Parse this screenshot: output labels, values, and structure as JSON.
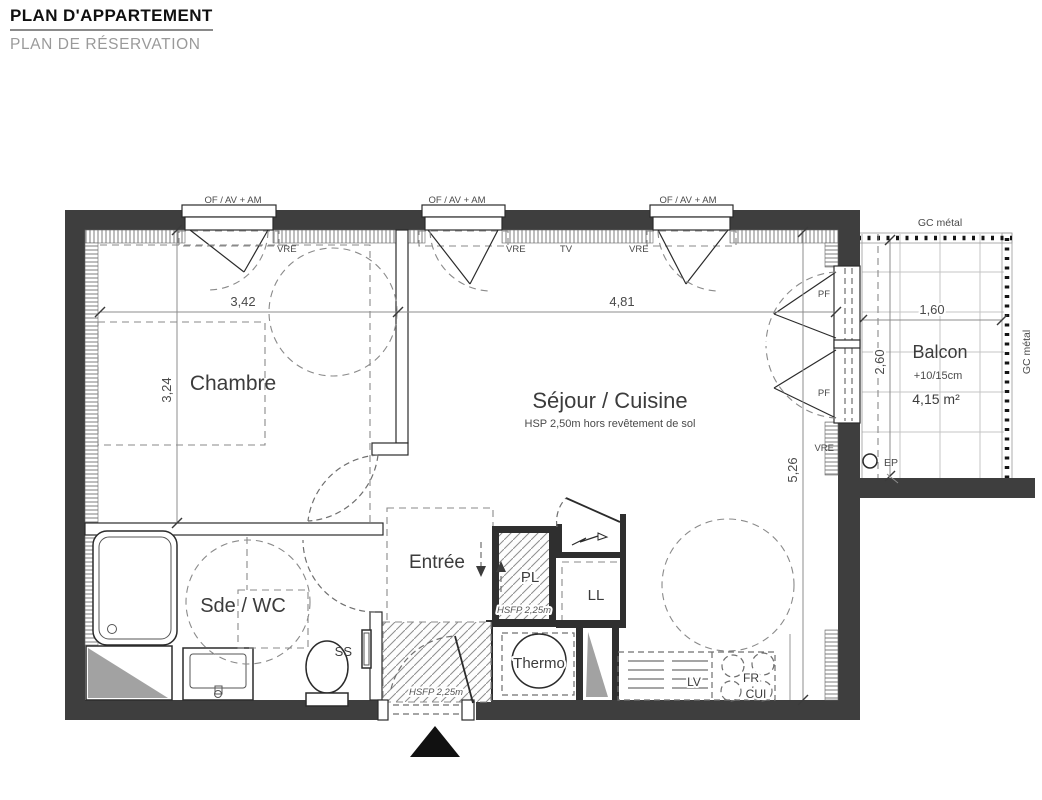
{
  "header": {
    "title": "PLAN D'APPARTEMENT",
    "subtitle": "PLAN DE RÉSERVATION"
  },
  "plan": {
    "window_label": "OF / AV + AM",
    "labels": {
      "vre": "VRE",
      "tv": "TV",
      "pf": "PF",
      "ep": "EP",
      "gc_metal": "GC métal",
      "ss": "SS"
    },
    "rooms": {
      "chambre": "Chambre",
      "sejour": "Séjour / Cuisine",
      "sejour_note": "HSP 2,50m hors revêtement de sol",
      "sde_wc": "Sde / WC",
      "entree": "Entrée",
      "pl": "PL",
      "ll": "LL",
      "thermo": "Thermo",
      "lv": "LV",
      "fr": "FR",
      "cui": "CUI",
      "balcon": "Balcon",
      "balcon_level": "+10/15cm",
      "balcon_area": "4,15 m²"
    },
    "notes": {
      "hsfp": "HSFP 2,25m"
    },
    "dimensions": {
      "chambre_width": "3,42",
      "sejour_width": "4,81",
      "chambre_depth": "3,24",
      "sejour_depth": "5,26",
      "balcon_width": "1,60",
      "balcon_depth": "2,60"
    },
    "colors": {
      "wall": "#3e3e3e",
      "duct": "#a2a2a2"
    }
  }
}
